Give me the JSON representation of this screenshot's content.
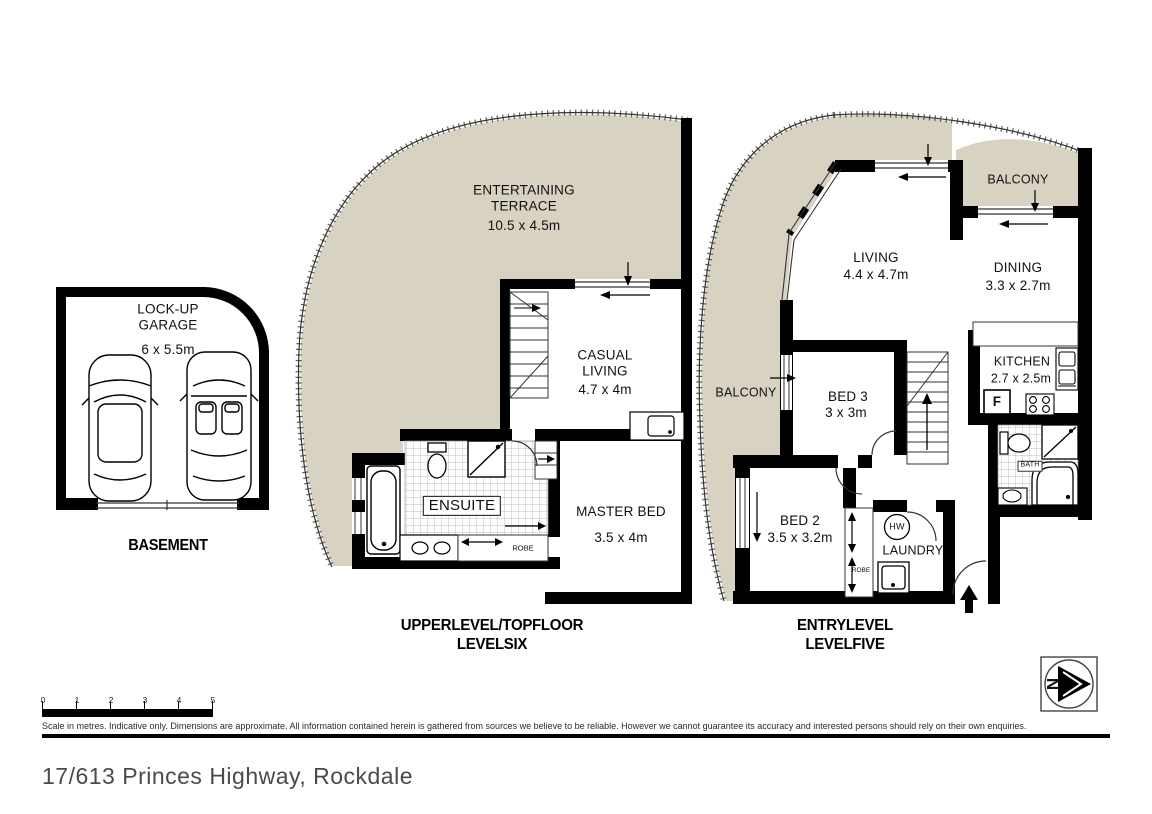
{
  "address": "17/613 Princes Highway, Rockdale",
  "colors": {
    "outdoor_fill": "#d8d2c2",
    "wall": "#000000",
    "tile_line": "#a8a8a8"
  },
  "basement": {
    "caption": "BASEMENT",
    "garage": {
      "name": "LOCK-UP GARAGE",
      "dims": "6 x 5.5m"
    }
  },
  "upper_level": {
    "caption_line1": "UPPER LEVEL/TOP FLOOR",
    "caption_line2": "LEVEL SIX",
    "rooms": {
      "terrace": {
        "name": "ENTERTAINING TERRACE",
        "dims": "10.5 x 4.5m"
      },
      "casual_living": {
        "name": "CASUAL LIVING",
        "dims": "4.7 x 4m"
      },
      "ensuite": {
        "name": "ENSUITE"
      },
      "robe": {
        "name": "ROBE"
      },
      "master_bed": {
        "name": "MASTER BED",
        "dims": "3.5 x 4m"
      }
    }
  },
  "entry_level": {
    "caption_line1": "ENTRY LEVEL",
    "caption_line2": "LEVEL FIVE",
    "rooms": {
      "balcony_west": {
        "name": "BALCONY"
      },
      "balcony_north": {
        "name": "BALCONY"
      },
      "living": {
        "name": "LIVING",
        "dims": "4.4 x 4.7m"
      },
      "dining": {
        "name": "DINING",
        "dims": "3.3 x 2.7m"
      },
      "kitchen": {
        "name": "KITCHEN",
        "dims": "2.7 x 2.5m",
        "fridge": "F"
      },
      "bath": {
        "name": "BATH"
      },
      "bed3": {
        "name": "BED 3",
        "dims": "3 x 3m"
      },
      "bed2": {
        "name": "BED 2",
        "dims": "3.5 x 3.2m"
      },
      "laundry": {
        "name": "LAUNDRY",
        "hot_water": "HW"
      },
      "robe": {
        "name": "ROBE"
      }
    }
  },
  "scale_bar": {
    "ticks": [
      "0",
      "1",
      "2",
      "3",
      "4",
      "5"
    ],
    "caption": "Scale in metres. Indicative only. Dimensions are approximate. All information contained herein is gathered from sources we believe to be reliable. However we cannot guarantee its accuracy and interested persons should rely on their own enquiries."
  },
  "compass": {
    "label": "N"
  }
}
